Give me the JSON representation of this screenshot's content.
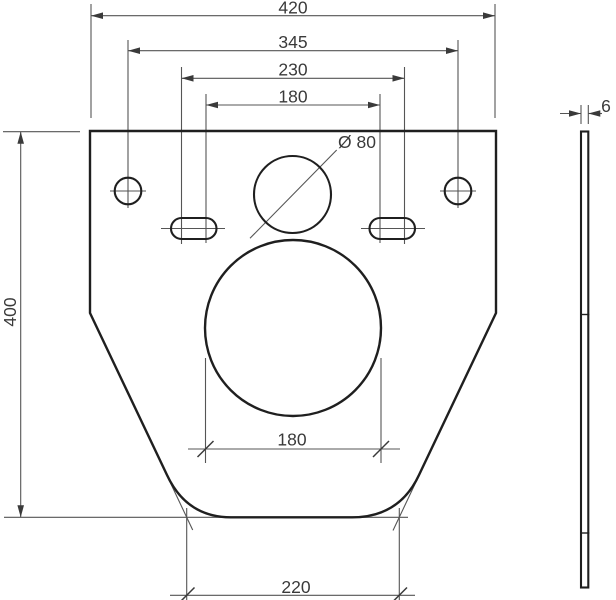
{
  "drawing": {
    "description": "Dimensioned technical drawing of a mounting plate (front view and side view)",
    "colors": {
      "background": "#ffffff",
      "outline": "#1f1f1f",
      "dimension_lines": "#555555",
      "text": "#3a3a3a"
    },
    "front_view": {
      "shape": "plate with straight top, vertical sides, tapered lower sides and rounded bottom",
      "features": [
        "left small round hole",
        "right small round hole",
        "left oblong slot",
        "right oblong slot",
        "top center circle diameter 80",
        "large center circle diameter 180"
      ]
    },
    "side_view": {
      "shape": "thin vertical plate profile with two segment tick marks"
    },
    "dimensions": {
      "overall_width": {
        "label": "420"
      },
      "hole_center_distance": {
        "label": "345"
      },
      "slot_outer_distance": {
        "label": "230"
      },
      "slot_inner_distance": {
        "label": "180"
      },
      "overall_height": {
        "label": "400"
      },
      "top_hole_diameter": {
        "label": "Ø 80"
      },
      "large_hole_diameter": {
        "label": "180"
      },
      "bottom_width": {
        "label": "220"
      },
      "plate_thickness": {
        "label": "6"
      }
    }
  }
}
